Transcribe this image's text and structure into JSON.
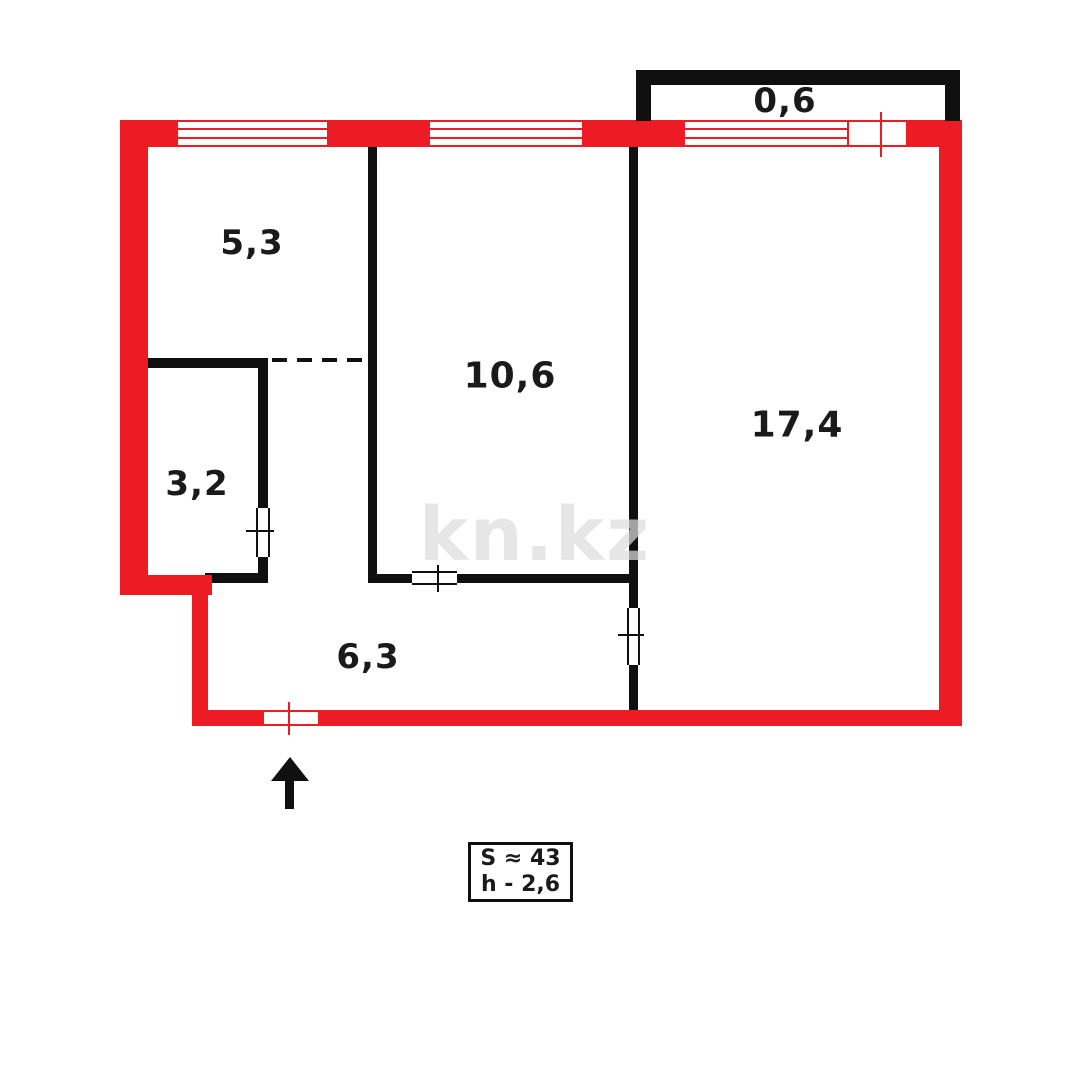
{
  "plan": {
    "watermark": "kn.kz",
    "colors": {
      "outer_wall": "#ED1C24",
      "inner_wall": "#101010",
      "label_text": "#1a1a1a",
      "background": "#ffffff"
    },
    "rooms": [
      {
        "id": "balcony",
        "area_label": "0,6"
      },
      {
        "id": "room-a",
        "area_label": "5,3"
      },
      {
        "id": "room-b",
        "area_label": "10,6"
      },
      {
        "id": "room-c",
        "area_label": "17,4"
      },
      {
        "id": "bathroom",
        "area_label": "3,2"
      },
      {
        "id": "hallway",
        "area_label": "6,3"
      }
    ],
    "summary": {
      "total_area": "S ≈ 43",
      "ceiling_height": "h - 2,6"
    }
  }
}
